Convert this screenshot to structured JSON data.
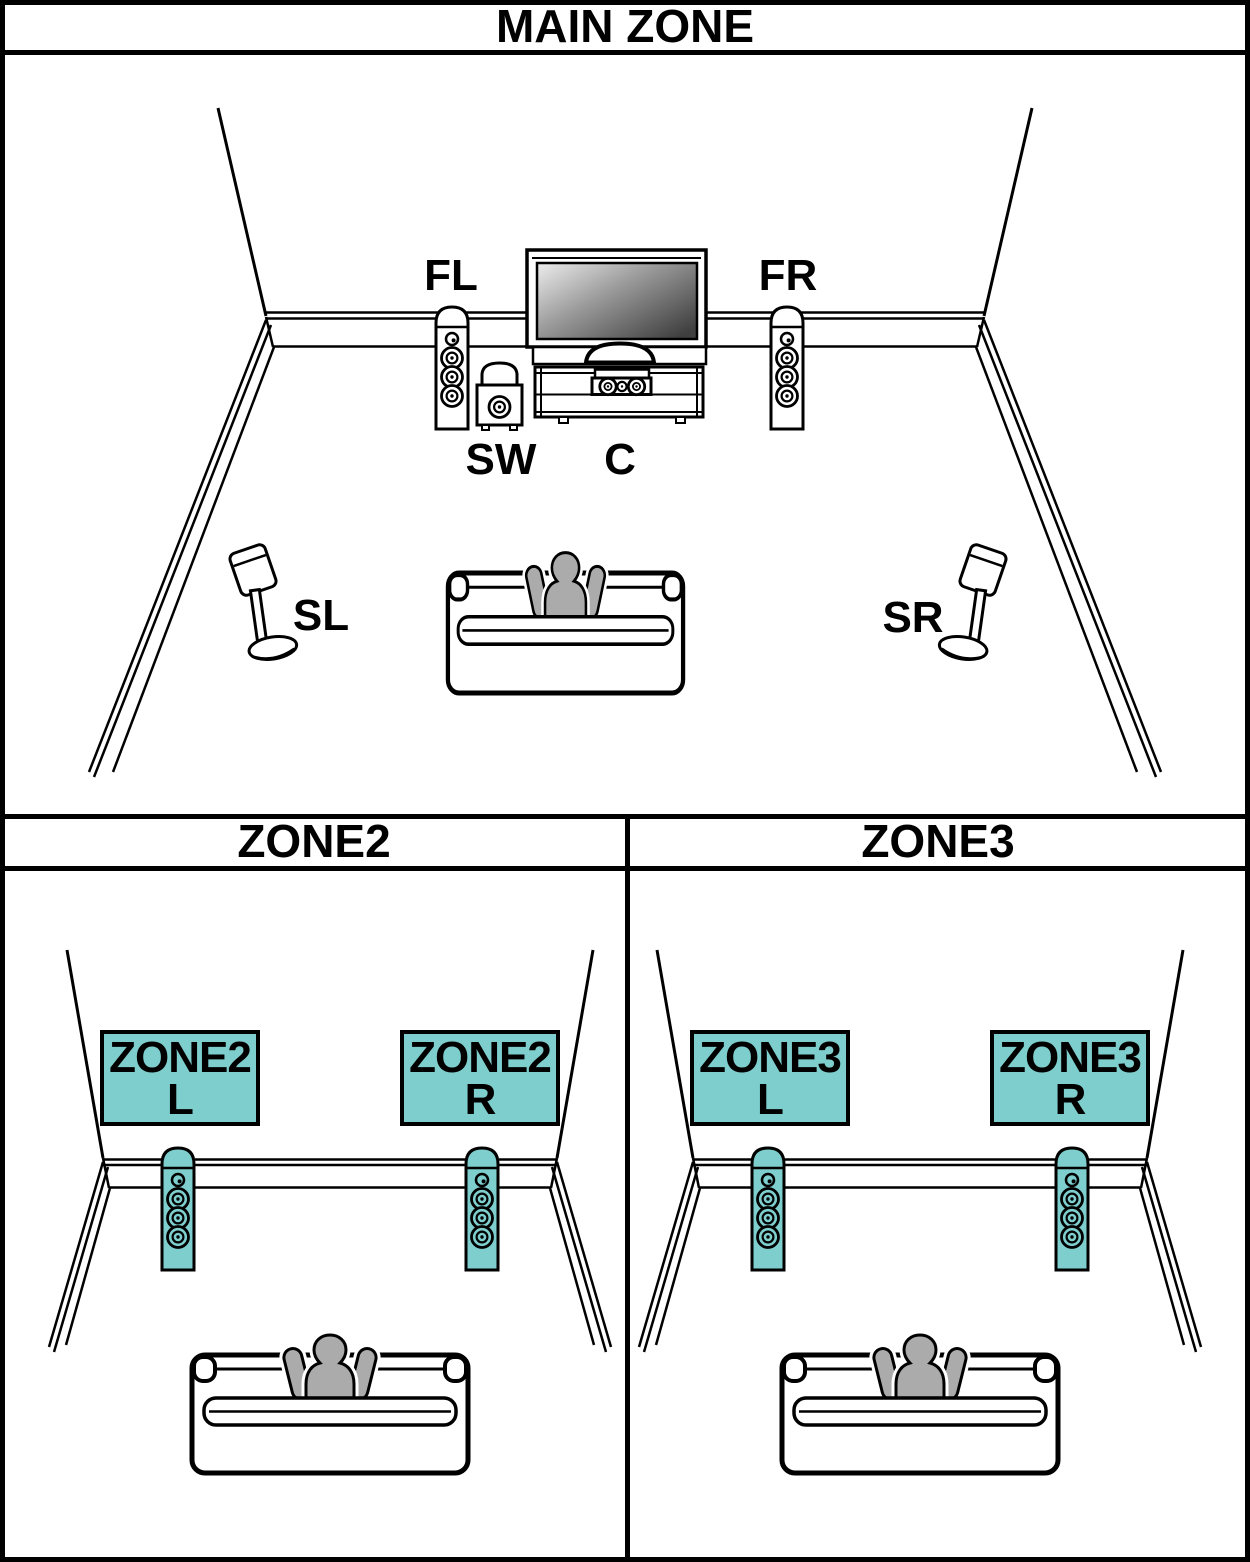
{
  "page": {
    "main_zone_title": "MAIN ZONE",
    "zone2_title": "ZONE2",
    "zone3_title": "ZONE3"
  },
  "colors": {
    "speaker_teal": "#7ECECE",
    "person_gray": "#ABABAB",
    "line_black": "#000000",
    "background": "#FFFFFF",
    "tv_screen_dark": "#3F3F3F",
    "tv_screen_light": "#ECECEC"
  },
  "main_zone": {
    "speaker_labels": {
      "front_left": "FL",
      "front_right": "FR",
      "subwoofer": "SW",
      "center": "C",
      "surround_left": "SL",
      "surround_right": "SR"
    }
  },
  "zone2": {
    "left_box": {
      "line1": "ZONE2",
      "line2": "L"
    },
    "right_box": {
      "line1": "ZONE2",
      "line2": "R"
    }
  },
  "zone3": {
    "left_box": {
      "line1": "ZONE3",
      "line2": "L"
    },
    "right_box": {
      "line1": "ZONE3",
      "line2": "R"
    }
  }
}
